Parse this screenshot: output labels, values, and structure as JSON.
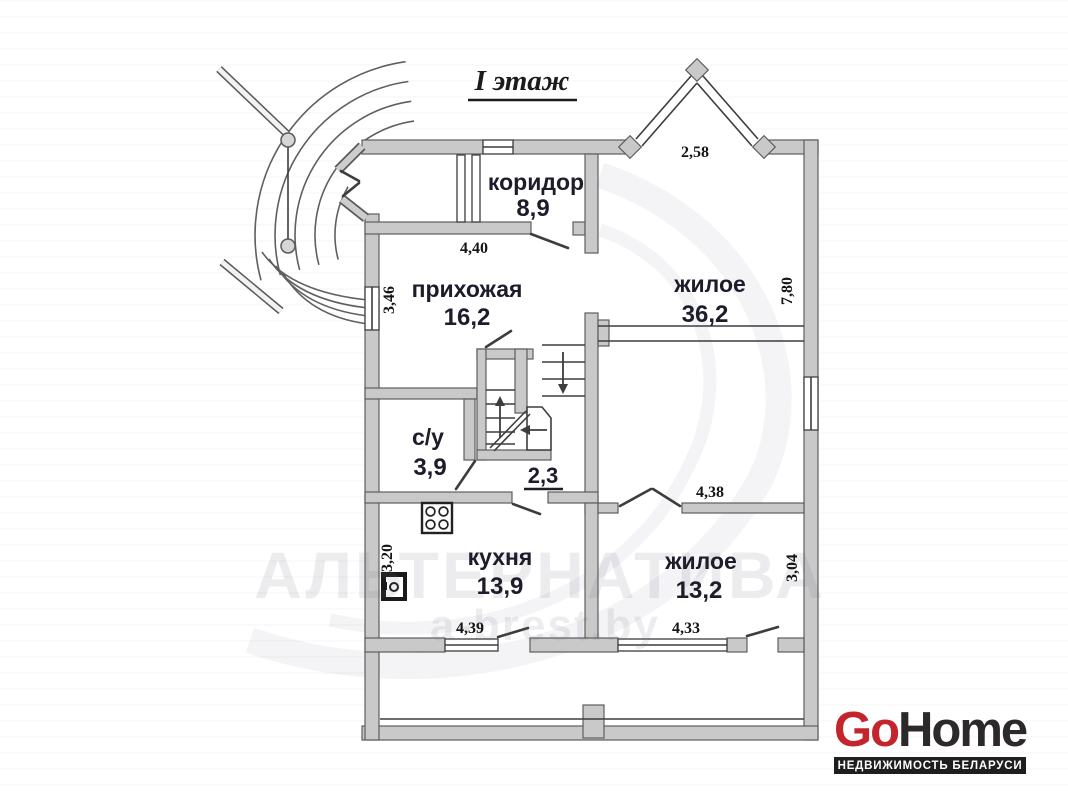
{
  "plan": {
    "title": "I этаж",
    "rooms": [
      {
        "name": "коридор",
        "area": "8,9"
      },
      {
        "name": "прихожая",
        "area": "16,2"
      },
      {
        "name": "жилое",
        "area": "36,2"
      },
      {
        "name": "с/у",
        "area": "3,9"
      },
      {
        "name": "",
        "area": "2,3"
      },
      {
        "name": "кухня",
        "area": "13,9"
      },
      {
        "name": "жилое",
        "area": "13,2"
      }
    ],
    "dims": {
      "bay_width": "2,58",
      "prihozhaya_width": "4,40",
      "prihozhaya_depth": "3,46",
      "zhiloe1_depth": "7,80",
      "zhiloe2_width_top": "4,38",
      "zhiloe2_depth": "3,04",
      "kuhnya_width": "4,39",
      "zhiloe2_width_bottom": "4,33",
      "kuhnya_depth": "3,20"
    }
  },
  "watermark": {
    "line1": "АЛЬТЕРНАТИВА",
    "line2": "a-brest.by"
  },
  "logo": {
    "go": "Go",
    "home": "Home",
    "tagline": "НЕДВИЖИМОСТЬ БЕЛАРУСИ",
    "colors": {
      "go_red": "#c4242b",
      "home_dark": "#2d292a",
      "bar_bg": "#1e1e1e",
      "bar_text": "#ffffff"
    }
  }
}
